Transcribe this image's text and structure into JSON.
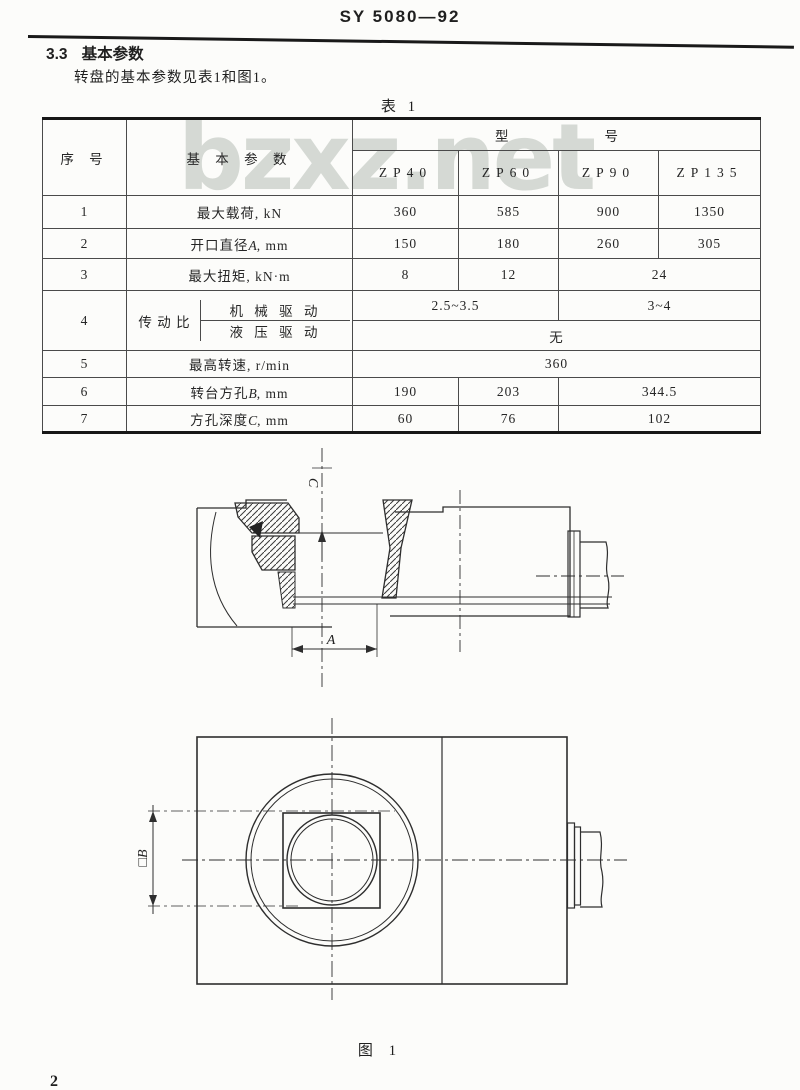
{
  "page": {
    "doc_code": "SY 5080—92",
    "section_no": "3.3",
    "section_title": "基本参数",
    "intro": "转盘的基本参数见表1和图1。",
    "table_caption": "表 1",
    "figure_caption": "图 1",
    "page_number": "2",
    "watermark": "bzxz.net"
  },
  "table": {
    "header": {
      "col_index": "序    号",
      "col_param": "基 本 参 数",
      "model_label_left": "型",
      "model_label_right": "号",
      "models": [
        "ZP40",
        "ZP60",
        "ZP90",
        "ZP135"
      ]
    },
    "rows": {
      "r1": {
        "no": "1",
        "label": "最大载荷, kN",
        "v1": "360",
        "v2": "585",
        "v3": "900",
        "v4": "1350"
      },
      "r2": {
        "no": "2",
        "label_pre": "开口直径",
        "label_var": "A",
        "label_post": ", mm",
        "v1": "150",
        "v2": "180",
        "v3": "260",
        "v4": "305"
      },
      "r3": {
        "no": "3",
        "label": "最大扭矩, kN·m",
        "v1": "8",
        "v2": "12",
        "v34": "24"
      },
      "r4": {
        "no": "4",
        "label": "传 动 比",
        "mech_label": "机 械 驱 动",
        "mech_v12": "2.5~3.5",
        "mech_v34": "3~4",
        "hyd_label": "液 压 驱 动",
        "hyd_v": "无"
      },
      "r5": {
        "no": "5",
        "label": "最高转速, r/min",
        "v": "360"
      },
      "r6": {
        "no": "6",
        "label_pre": "转台方孔",
        "label_var": "B",
        "label_post": ", mm",
        "v1": "190",
        "v2": "203",
        "v34": "344.5"
      },
      "r7": {
        "no": "7",
        "label_pre": "方孔深度",
        "label_var": "C",
        "label_post": ", mm",
        "v1": "60",
        "v2": "76",
        "v34": "102"
      }
    }
  },
  "figure": {
    "section_view": {
      "c_label": "C",
      "a_label": "A"
    },
    "plan_view": {
      "b_label": "□B"
    }
  }
}
